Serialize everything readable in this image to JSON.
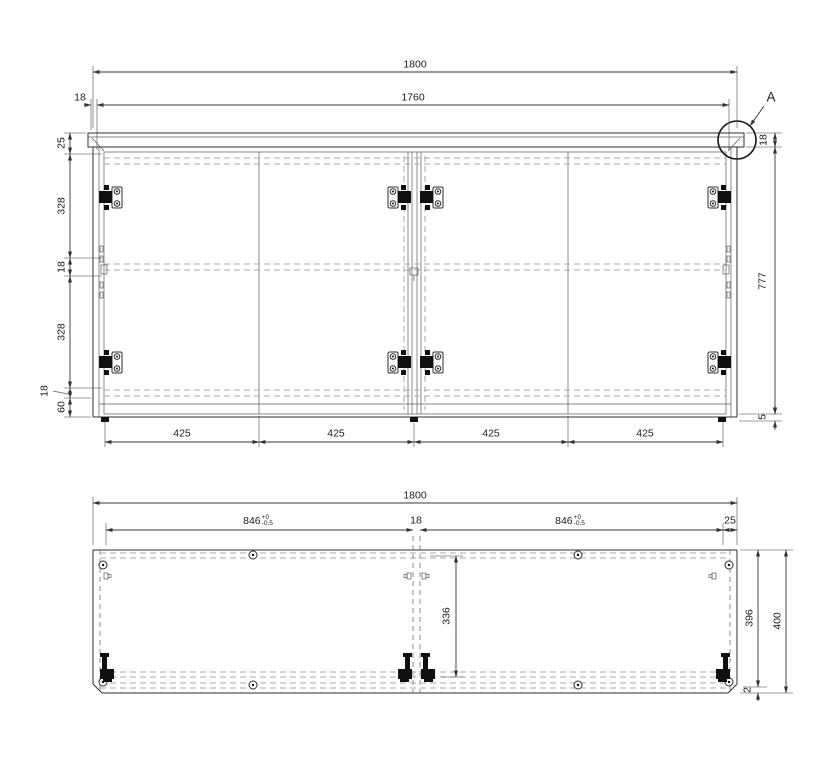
{
  "drawing": {
    "detail_marker": "A",
    "front_view": {
      "overall_width": "1800",
      "opening_width": "1760",
      "side_panel_thickness": "18",
      "top_clearance": "25",
      "upper_section_height": "328",
      "mid_shelf_thickness": "18",
      "lower_section_height": "328",
      "bottom_panel_thickness": "18",
      "plinth_height": "60",
      "overall_height": "777",
      "top_panel_thickness": "18",
      "bottom_reveal": "5",
      "door_widths": [
        "425",
        "425",
        "425",
        "425"
      ]
    },
    "plan_view": {
      "overall_width": "1800",
      "left_bay": {
        "value": "846",
        "tol_plus": "+0",
        "tol_minus": "-0.5"
      },
      "divider_thickness": "18",
      "right_bay": {
        "value": "846",
        "tol_plus": "+0",
        "tol_minus": "-0.5"
      },
      "right_offset": "25",
      "inner_depth": "336",
      "carcass_depth": "396",
      "overall_depth": "400",
      "front_reveal": "2"
    }
  }
}
